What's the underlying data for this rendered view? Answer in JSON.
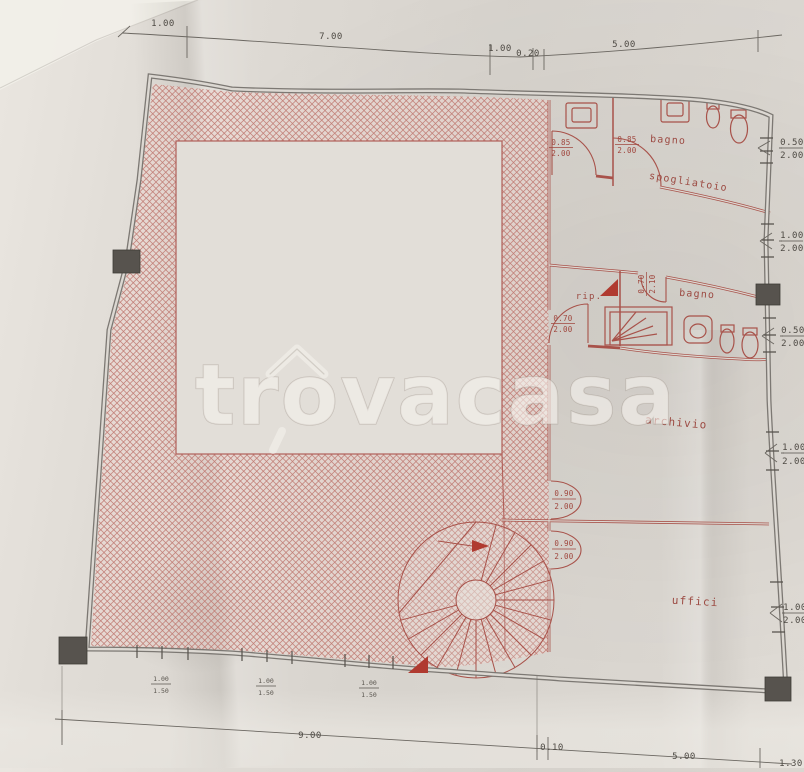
{
  "watermark": {
    "pre": "tr",
    "o": "o",
    "post": "vacasa"
  },
  "rooms": {
    "bagno_top": "bagno",
    "spogliatoio": "spogliatoio",
    "rip": "rip.",
    "bagno_mid": "bagno",
    "archivio": "archivio",
    "ufficio": "uffici"
  },
  "dims": {
    "top": [
      "1.00",
      "7.00",
      "1.00",
      "0.20",
      "5.00"
    ],
    "bottom": [
      "9.00",
      "0.10",
      "5.00",
      "1.30"
    ],
    "right_windows": [
      {
        "w": "0.50",
        "h": "2.00"
      },
      {
        "w": "1.00",
        "h": "2.00"
      },
      {
        "w": "0.50",
        "h": "2.00"
      },
      {
        "w": "1.00",
        "h": "2.00"
      },
      {
        "w": "1.00",
        "h": "2.00"
      }
    ],
    "doors": [
      {
        "w": "0.85",
        "h": "2.00"
      },
      {
        "w": "0.85",
        "h": "2.00"
      },
      {
        "w": "0.70",
        "h": "2.00"
      },
      {
        "w": "0.70",
        "h": "2.10"
      },
      {
        "w": "0.90",
        "h": "2.00"
      },
      {
        "w": "0.90",
        "h": "2.00"
      }
    ],
    "bottom_windows": [
      {
        "w": "1.00",
        "h": "1.50"
      },
      {
        "w": "1.00",
        "h": "1.50"
      },
      {
        "w": "1.00",
        "h": "1.50"
      }
    ]
  },
  "colors": {
    "plan_red": "#a8524a",
    "wall_gray": "#7c7873",
    "hatch_pink": "#bf7a72",
    "paper": "#dcd8d2",
    "dim_text": "#4e4a44",
    "pillar_dark": "#57534e"
  }
}
